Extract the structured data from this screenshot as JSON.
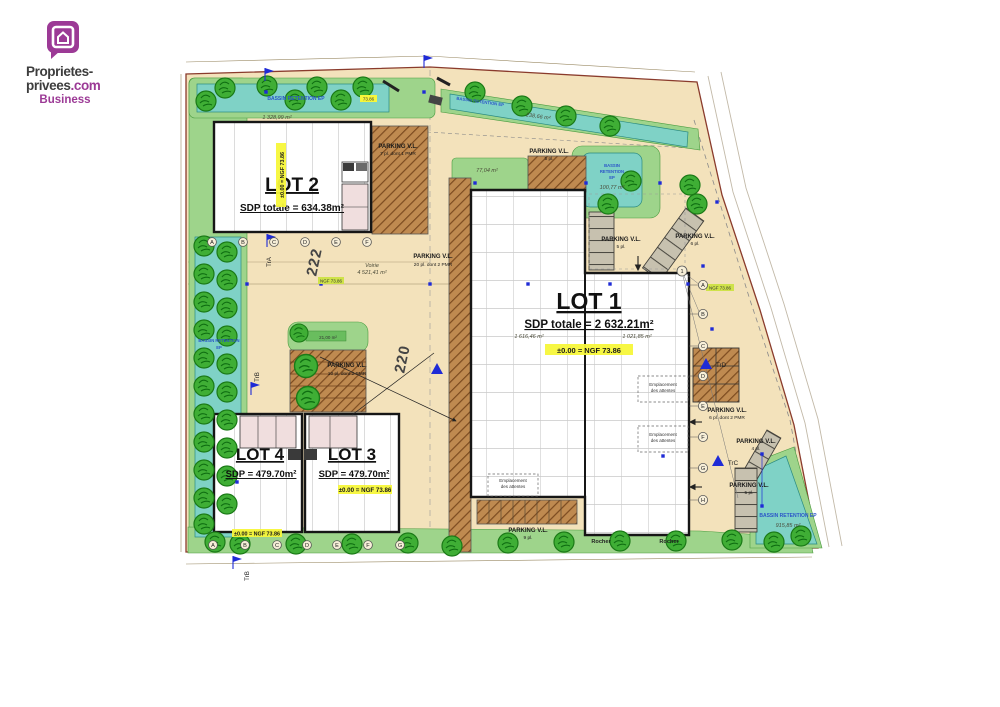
{
  "logo": {
    "l1": "Proprietes-",
    "l2a": "privees",
    "l2b": ".com",
    "l3": "Business"
  },
  "lots": {
    "lot1": {
      "title": "LOT 1",
      "sdp": "SDP totale = 2 632.21m²",
      "level": "±0.00 = NGF 73.86",
      "area_left": "1 616,46 m²",
      "area_right": "1 021,85 m²"
    },
    "lot2": {
      "title": "LOT 2",
      "sdp": "SDP totale = 634.38m²",
      "level": "±0.00 = NGF 73.86"
    },
    "lot3": {
      "title": "LOT 3",
      "sdp": "SDP = 479.70m²",
      "level": "±0.00 = NGF 73.86"
    },
    "lot4": {
      "title": "LOT 4",
      "sdp": "SDP = 479.70m²",
      "level": "±0.00 = NGF 73.86"
    }
  },
  "basins": {
    "top": {
      "name": "BASSIN RETENTION EP",
      "area": "1 328,99 m²",
      "level": "73.86"
    },
    "top_right": {
      "name": "BASSIN RETENTION EP",
      "area": "238,66 m²"
    },
    "left": {
      "name1": "BASSIN RETENTION",
      "name2": "EP"
    },
    "mid": {
      "name1": "BASSIN",
      "name2": "RETENTION",
      "name3": "EP",
      "area": "100,77 m²"
    },
    "bottom_right": {
      "name": "BASSIN RETENTION EP",
      "area": "915,85 m²"
    }
  },
  "parking": {
    "p_top": {
      "l": "PARKING V.L.",
      "c": "5 pl."
    },
    "p_lot2": {
      "l": "PARKING V.L.",
      "c": "7 pl. dont 1 PMR"
    },
    "p_island": {
      "l": "PARKING V.L.",
      "c": "10 pl. dont 2 PMR",
      "area": "21,00 m²"
    },
    "p_strip": {
      "l": "PARKING V.L.",
      "c": "20 pl. dont 2 PMR"
    },
    "p_lot1top": {
      "l": "PARKING V.L.",
      "c": "5 pl."
    },
    "p_right1": {
      "l": "PARKING V.L.",
      "c": "6 pl."
    },
    "p_right2": {
      "l": "PARKING V.L.",
      "c": "6 pl. dont 2 PMR"
    },
    "p_right3": {
      "l": "PARKING V.L.",
      "c": "4 pl."
    },
    "p_right4": {
      "l": "PARKING V.L.",
      "c": "5 pl."
    },
    "p_bottom": {
      "l": "PARKING V.L.",
      "c": "9 pl."
    }
  },
  "road": {
    "name": "Voirie",
    "area": "4 521,41 m²",
    "n1": "222",
    "n2": "220"
  },
  "notes": {
    "rocher": "Rocher",
    "emp1": "Emplacement",
    "emp2": "des attentes",
    "green_area": "77,04 m²",
    "ngf": "NGF 73.86"
  },
  "markers": {
    "tra": "TrA",
    "trb": "TrB",
    "trc": "TrC",
    "trd": "TrD",
    "one": "1",
    "row_top": [
      "A",
      "B",
      "C",
      "D",
      "E",
      "F"
    ],
    "row_bottom": [
      "A",
      "B",
      "C",
      "D",
      "E",
      "F",
      "G"
    ],
    "col_right": [
      "A",
      "B",
      "C",
      "D",
      "E",
      "F",
      "G",
      "H"
    ]
  },
  "colors": {
    "brand_purple": "#9c3a96",
    "land": "#f3e2bb",
    "green": "#9ed48b",
    "teal": "#7fd2c6",
    "hatch_brown": "#bf8a50",
    "marker_blue": "#1f2bd6",
    "highlight_yellow": "#f7f73a"
  }
}
